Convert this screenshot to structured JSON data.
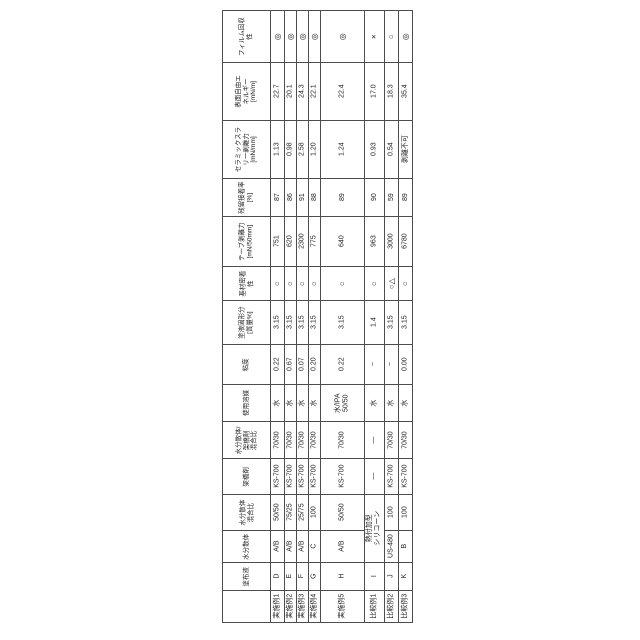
{
  "page": {
    "background": "#ffffff",
    "line_color": "#4d4d4d",
    "text_color": "#222222",
    "description_labels": {
      "circle_double": "◎",
      "circle": "○",
      "cross": "×",
      "circle_triangle": "○△",
      "dash": "—"
    }
  },
  "table": {
    "left": 222,
    "top": 10,
    "col_widths": [
      48,
      14,
      12,
      12,
      12,
      44,
      20,
      14,
      14
    ],
    "row_heights": [
      52,
      58,
      58,
      38,
      50,
      34,
      44,
      40,
      37,
      37,
      36,
      36,
      32,
      28,
      32
    ],
    "rows": [
      {
        "name": "film-recovery",
        "header": "フィルム回収\n性",
        "symbol": true,
        "cells": [
          "◎",
          "◎",
          "◎",
          "◎",
          "◎",
          "×",
          "○",
          "◎"
        ]
      },
      {
        "name": "surface-free-energy",
        "header": "表面自由エ\nネルギー\n[mN/m]",
        "symbol": false,
        "cells": [
          "22.7",
          "20.1",
          "24.3",
          "22.1",
          "22.4",
          "17.0",
          "18.3",
          "35.4"
        ]
      },
      {
        "name": "ceramic-slurry-peel-force",
        "header": "セラミックスラ\nリー剥離力\n[mN/mm]",
        "symbol": false,
        "cells": [
          "1.13",
          "0.98",
          "2.58",
          "1.20",
          "1.24",
          "0.93",
          "0.54",
          "剥離不可"
        ]
      },
      {
        "name": "residual-adhesion-rate",
        "header": "残留接着率\n[%]",
        "symbol": false,
        "cells": [
          "87",
          "86",
          "91",
          "88",
          "89",
          "90",
          "59",
          "89"
        ]
      },
      {
        "name": "tape-peel-force",
        "header": "テープ剥離力\n[mN/50mm]",
        "symbol": false,
        "cells": [
          "751",
          "620",
          "2300",
          "775",
          "640",
          "963",
          "3000",
          "6780"
        ]
      },
      {
        "name": "substrate-adhesion",
        "header": "基材密着\n性",
        "symbol": true,
        "cells": [
          "○",
          "○",
          "○",
          "○",
          "○",
          "○",
          "○△",
          "○"
        ]
      },
      {
        "name": "coating-solid-content",
        "header": "塗液固形分\n[質量%]",
        "symbol": false,
        "cells": [
          "3.15",
          "3.15",
          "3.15",
          "3.15",
          "3.15",
          "1.4",
          "3.15",
          "3.15"
        ]
      },
      {
        "name": "viscosity",
        "header": "粘度",
        "symbol": false,
        "cells": [
          "0.22",
          "0.67",
          "0.07",
          "0.20",
          "0.22",
          "−",
          "−",
          "0.00"
        ]
      },
      {
        "name": "solvent-used",
        "header": "使用溶媒",
        "symbol": false,
        "cells": [
          "水",
          "水",
          "水",
          "水",
          "水/IPA\n50/50",
          "水",
          "水",
          "水"
        ]
      },
      {
        "name": "dispersion-crosslinker-ratio",
        "header": "水分散体/\n架橋剤\n混合比",
        "symbol": false,
        "cells": [
          "70/30",
          "70/30",
          "70/30",
          "70/30",
          "70/30",
          "—",
          "70/30",
          "70/30"
        ]
      },
      {
        "name": "crosslinker",
        "header": "架橋剤",
        "symbol": false,
        "cells": [
          "KS-700",
          "KS-700",
          "KS-700",
          "KS-700",
          "KS-700",
          "—",
          "KS-700",
          "KS-700"
        ]
      },
      {
        "name": "dispersion-mix-ratio",
        "header": "水分散体\n混合比",
        "symbol": false,
        "cells": [
          "50/50",
          "75/25",
          "25/75",
          "100",
          "50/50",
          null,
          "100",
          "100"
        ]
      },
      {
        "name": "water-dispersion",
        "header": "水分散体",
        "symbol": false,
        "cells": [
          "A/B",
          "A/B",
          "A/B",
          "C",
          "A/B",
          null,
          "US-480",
          "B"
        ]
      },
      {
        "name": "coating-liquid",
        "header": "塗布液",
        "symbol": false,
        "cells": [
          "D",
          "E",
          "F",
          "G",
          "H",
          "I",
          "J",
          "K"
        ]
      },
      {
        "name": "sample-labels",
        "header": "",
        "symbol": false,
        "cells": [
          "実施例1",
          "実施例2",
          "実施例3",
          "実施例4",
          "実施例5",
          "比較例1",
          "比較例2",
          "比較例3"
        ]
      }
    ],
    "merged_cell": {
      "text": "熱付加型\nシリコーン",
      "row": 12,
      "col": 7,
      "row_span": 2
    }
  }
}
